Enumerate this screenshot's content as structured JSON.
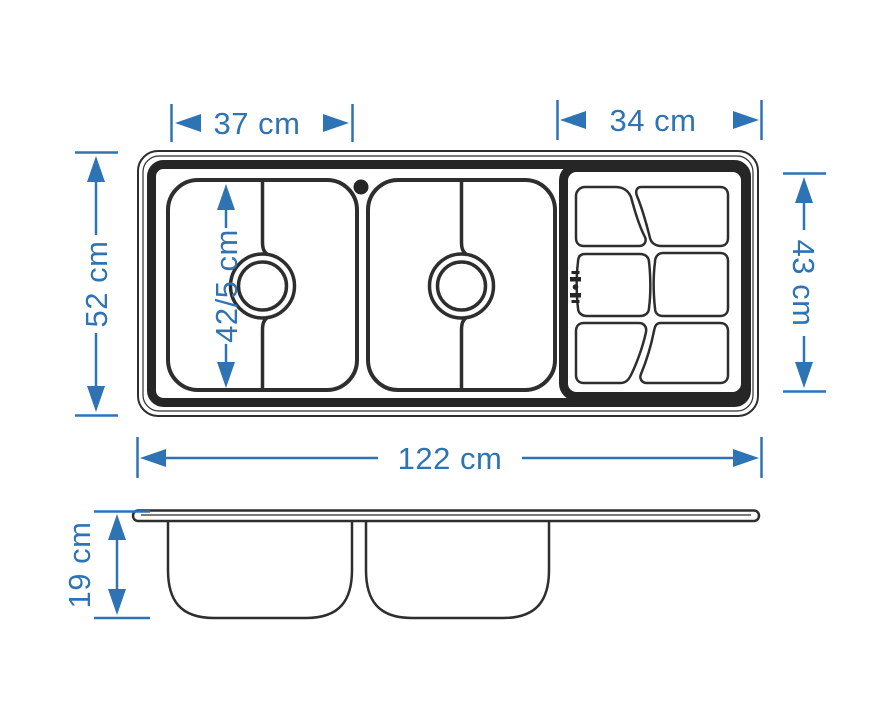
{
  "colors": {
    "dimension_blue": "#2e74b5",
    "line_dark": "#2e2e2e",
    "rim_black": "#262626",
    "background": "#ffffff"
  },
  "dimensions": {
    "left_bowl_width": "37 cm",
    "drainboard_width": "34 cm",
    "overall_depth": "52 cm",
    "drainboard_depth": "43 cm",
    "bowl_inner_length": "42/5 cm",
    "overall_length": "122 cm",
    "bowl_depth_side": "19 cm"
  }
}
